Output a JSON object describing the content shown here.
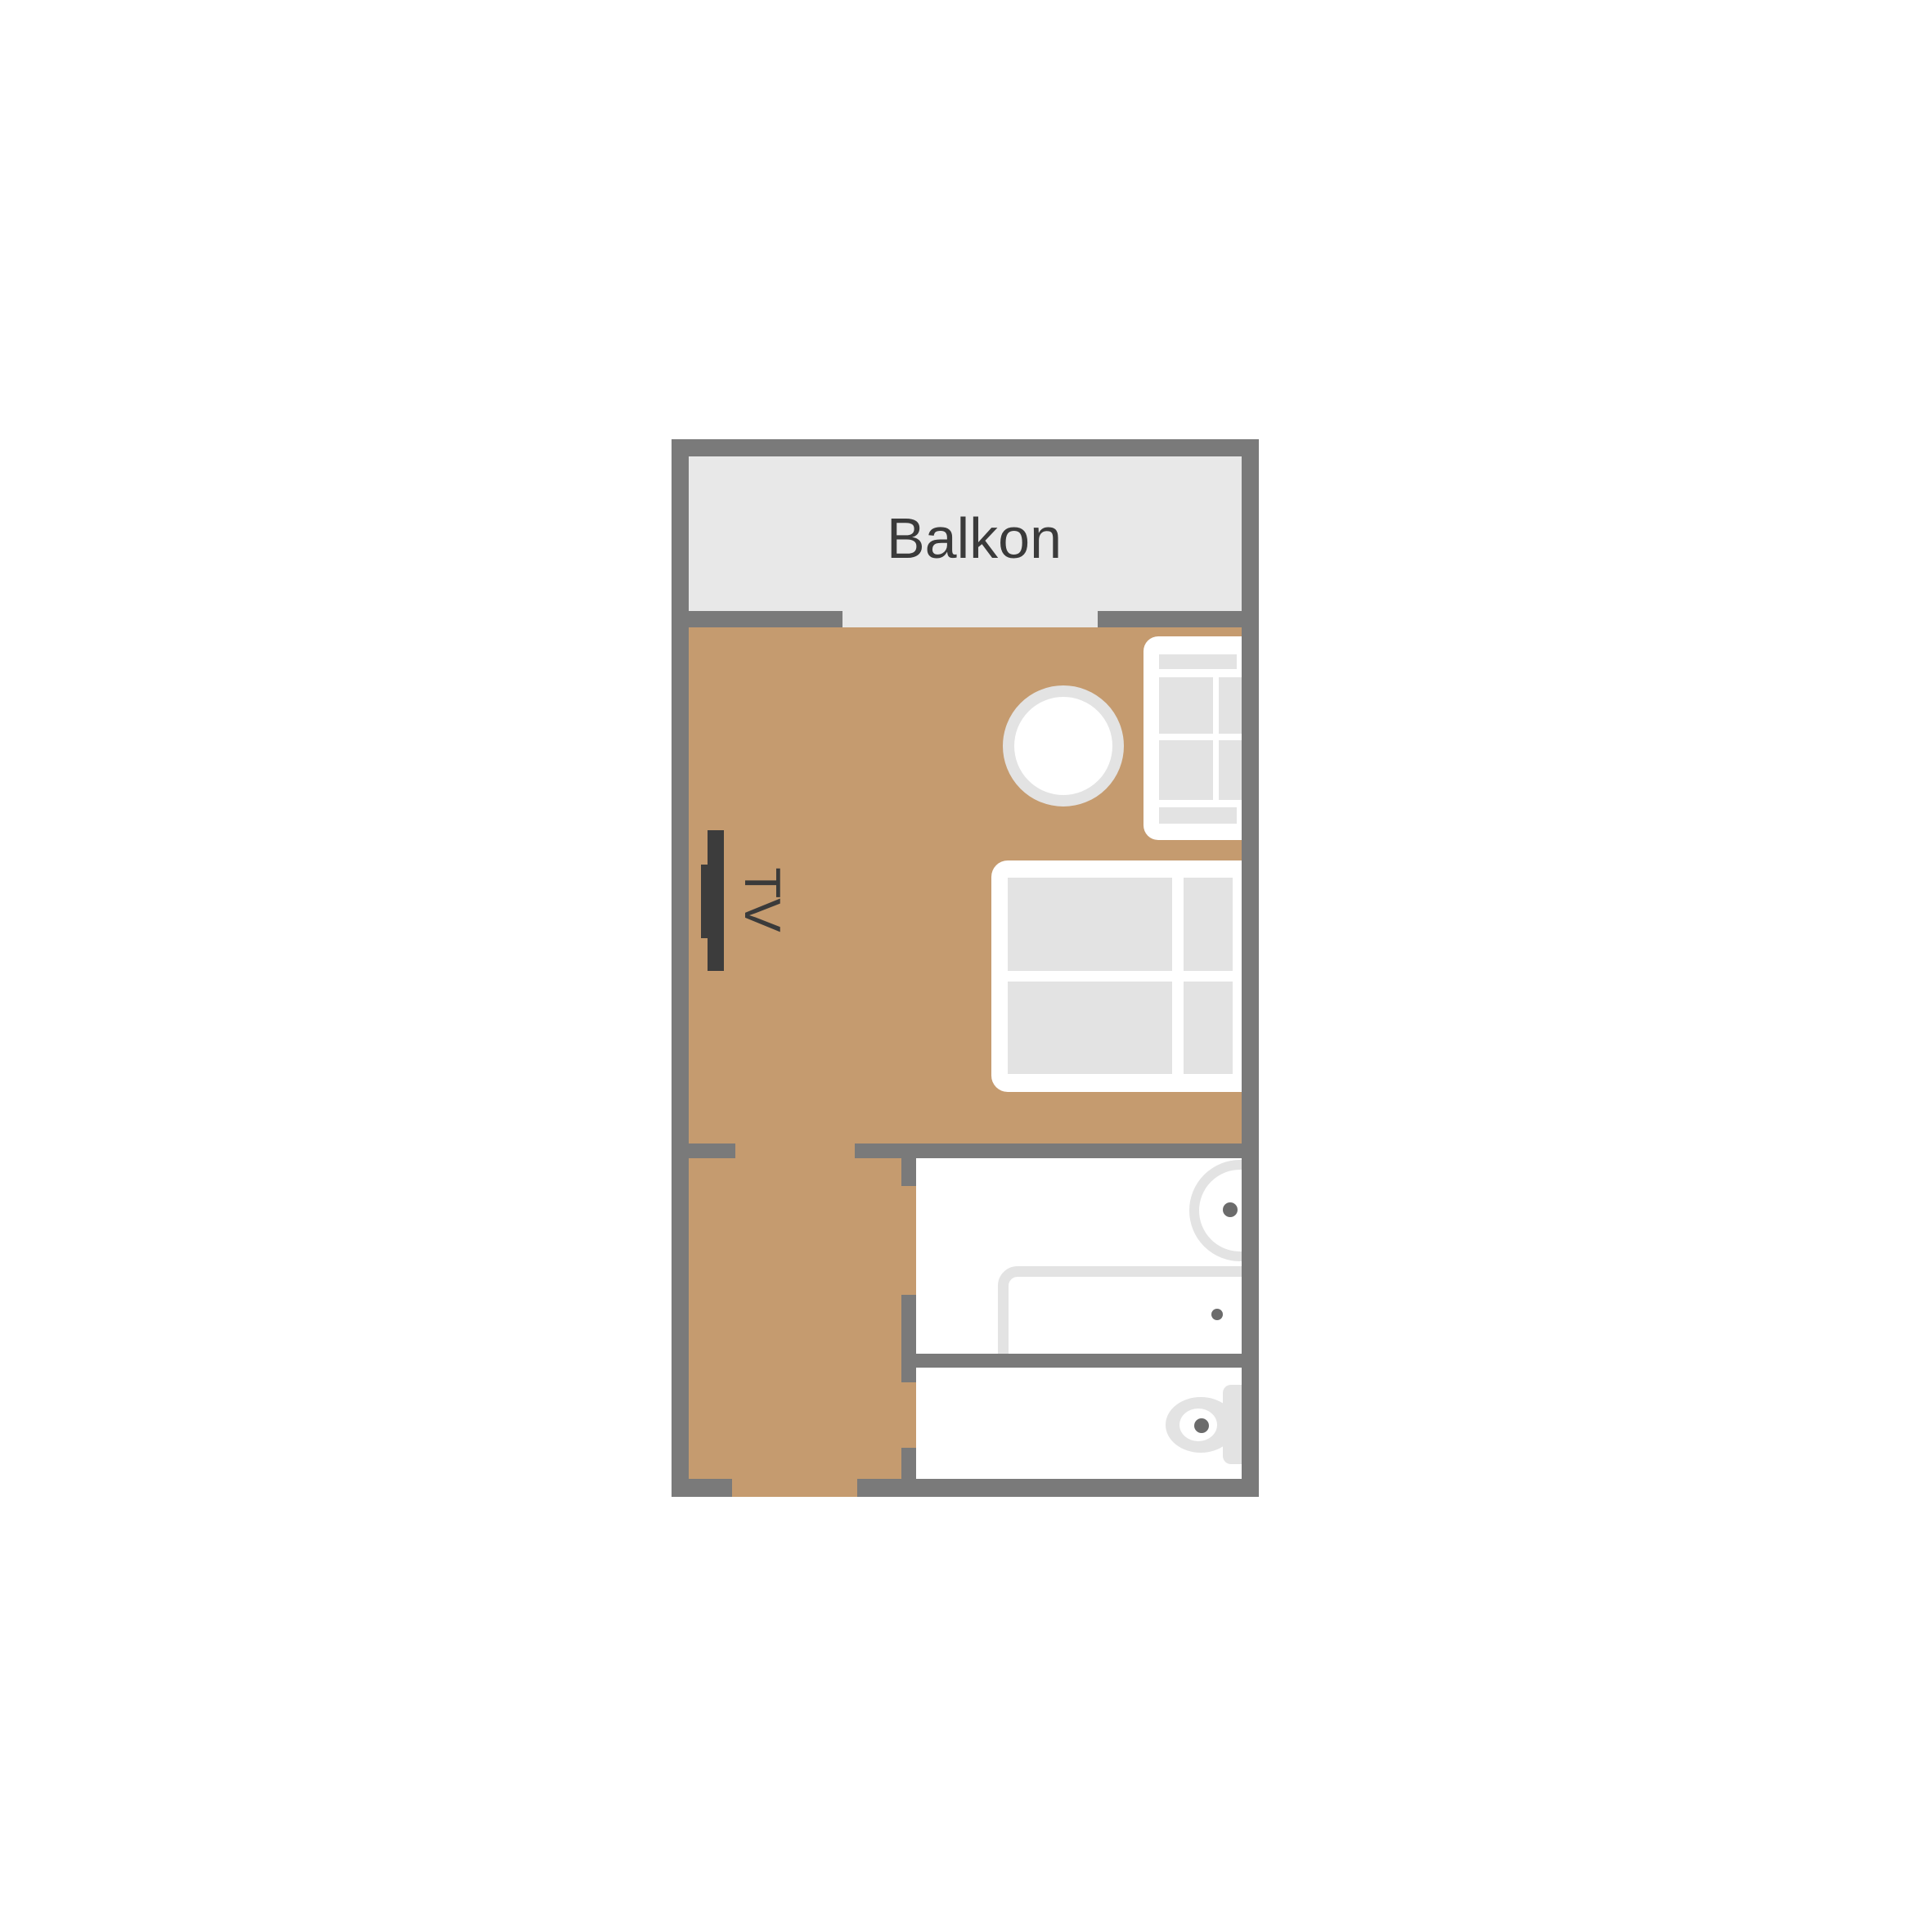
{
  "labels": {
    "balcony": "Balkon",
    "tv": "TV"
  },
  "colors": {
    "background": "#ffffff",
    "wall": "#7a7a7a",
    "balcony_floor": "#e8e8e8",
    "room_floor": "#c59b6f",
    "furniture_white": "#ffffff",
    "furniture_panel": "#e3e3e3",
    "fixture_outline": "#e3e3e3",
    "fixture_dot": "#6b6b6b",
    "tv_dark": "#3c3c3c",
    "label_text": "#3a3a3a"
  }
}
